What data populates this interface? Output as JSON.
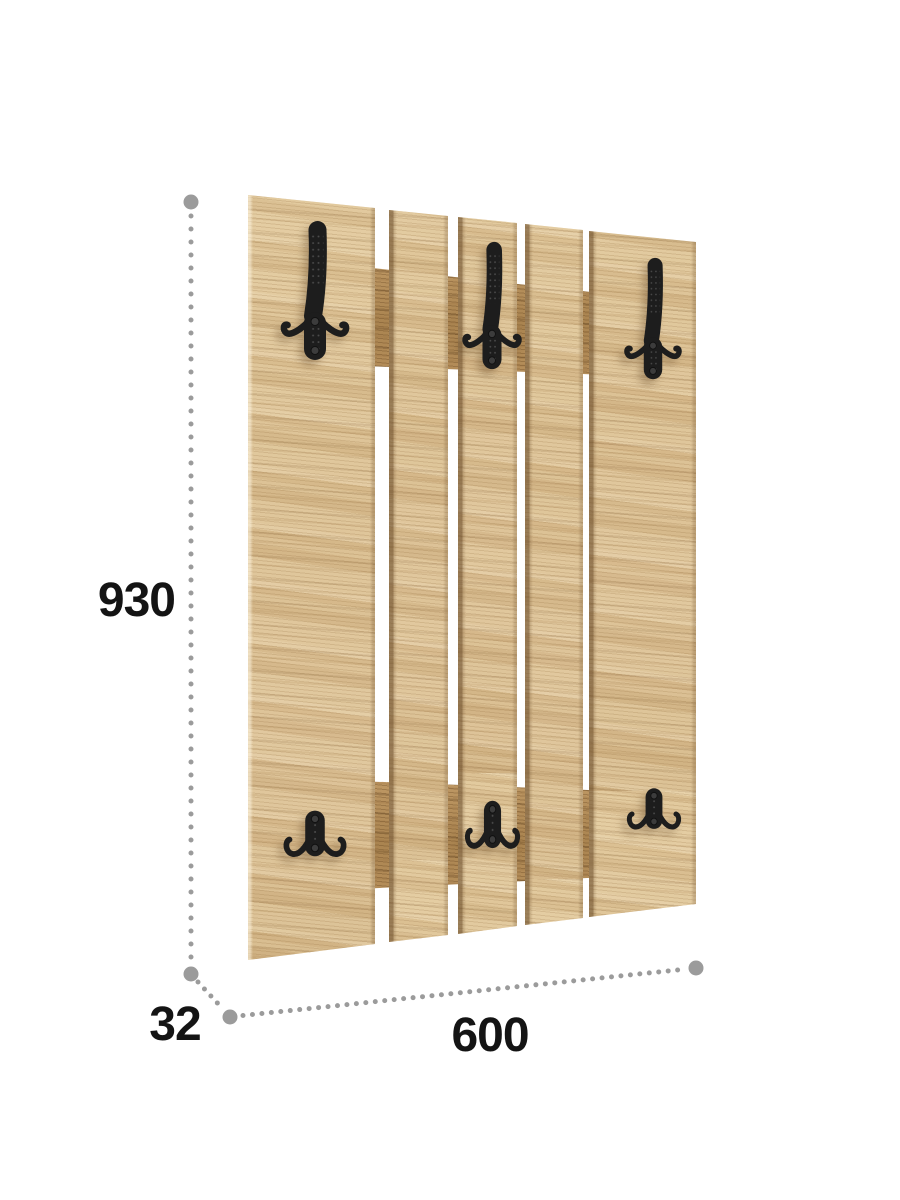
{
  "page": {
    "background": "#ffffff"
  },
  "dimensions": {
    "height_label": "930",
    "width_label": "600",
    "depth_label": "32"
  },
  "palette": {
    "background": "#ffffff",
    "wood_light": "#e2cba0",
    "wood_mid": "#d8bd90",
    "rail_wood": "#aa8450",
    "hook_black": "#1d1d1d",
    "dot_gray": "#9b9b9b",
    "label_color": "#141414"
  },
  "icons": {
    "hook_top": "coat-hook-tall-icon",
    "hook_bottom": "coat-hook-double-icon"
  }
}
